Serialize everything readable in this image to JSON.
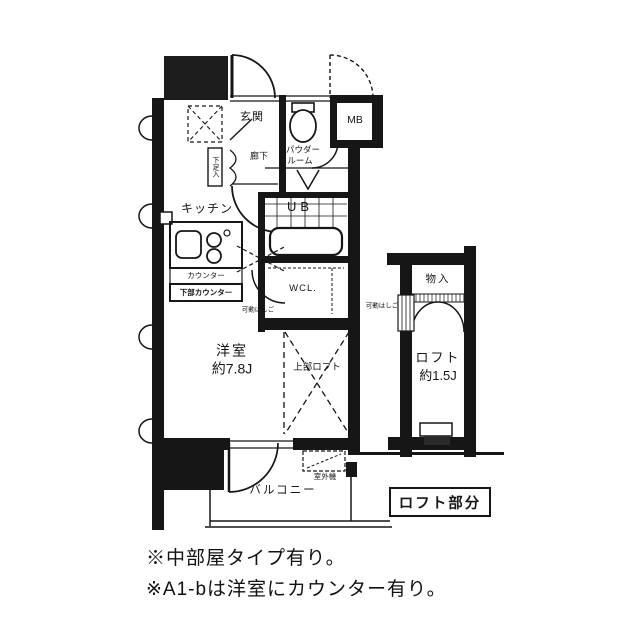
{
  "labels": {
    "genkan": "玄関",
    "mb": "MB",
    "rouka": "廊下",
    "powder_line1": "パウダー",
    "powder_line2": "ルーム",
    "shoe_box": "下足入",
    "kitchen": "キッチン",
    "counter": "カウンター",
    "lower_counter": "下部カウンター",
    "ub": "UB",
    "wcl": "WCL.",
    "ladder_left": "可動はしご",
    "western_room_line1": "洋室",
    "western_room_line2": "約7.8J",
    "upper_loft": "上部ロフト",
    "storage": "物入",
    "ladder_right": "可動はしご",
    "loft_line1": "ロフト",
    "loft_line2": "約1.5J",
    "outdoor_unit": "室外機",
    "balcony": "バルコニー",
    "loft_caption": "ロフト部分"
  },
  "notes": [
    "※中部屋タイプ有り。",
    "※A1-bは洋室にカウンター有り。"
  ],
  "colors": {
    "line": "#161616",
    "background": "#ffffff"
  }
}
